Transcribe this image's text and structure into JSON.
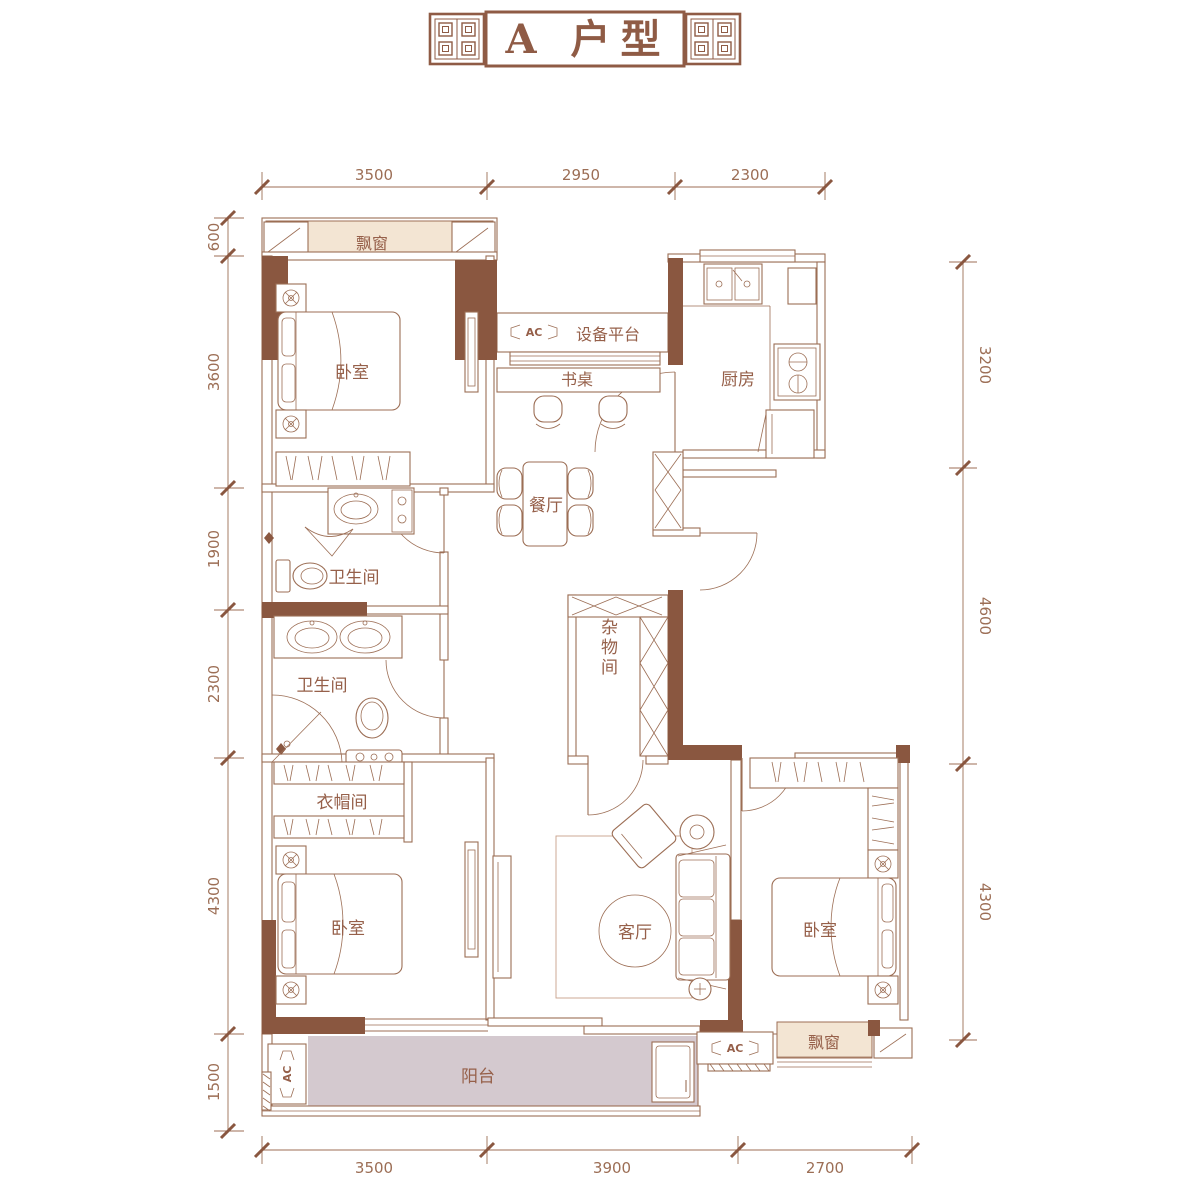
{
  "title": "A 户型",
  "colors": {
    "line": "#9c6e55",
    "wall_fill": "#8a5740",
    "bay_window_fill": "#f3e5d3",
    "balcony_fill": "#d4c9cf",
    "title_text": "#8f5b45"
  },
  "dims": {
    "top": [
      "3500",
      "2950",
      "2300"
    ],
    "bottom": [
      "3500",
      "3900",
      "2700"
    ],
    "left": [
      "600",
      "3600",
      "1900",
      "2300",
      "4300",
      "1500"
    ],
    "right": [
      "3200",
      "4600",
      "4300"
    ]
  },
  "labels": {
    "bedroom_tl": "卧室",
    "bedroom_bl": "卧室",
    "bedroom_br": "卧室",
    "kitchen": "厨房",
    "dining": "餐厅",
    "living": "客厅",
    "bath_upper": "卫生间",
    "bath_lower": "卫生间",
    "cloakroom": "衣帽间",
    "storage": "杂物间",
    "balcony": "阳台",
    "bay_top": "飘窗",
    "bay_bottom": "飘窗",
    "equipment": "设备平台",
    "desk": "书桌",
    "ac": "AC"
  }
}
